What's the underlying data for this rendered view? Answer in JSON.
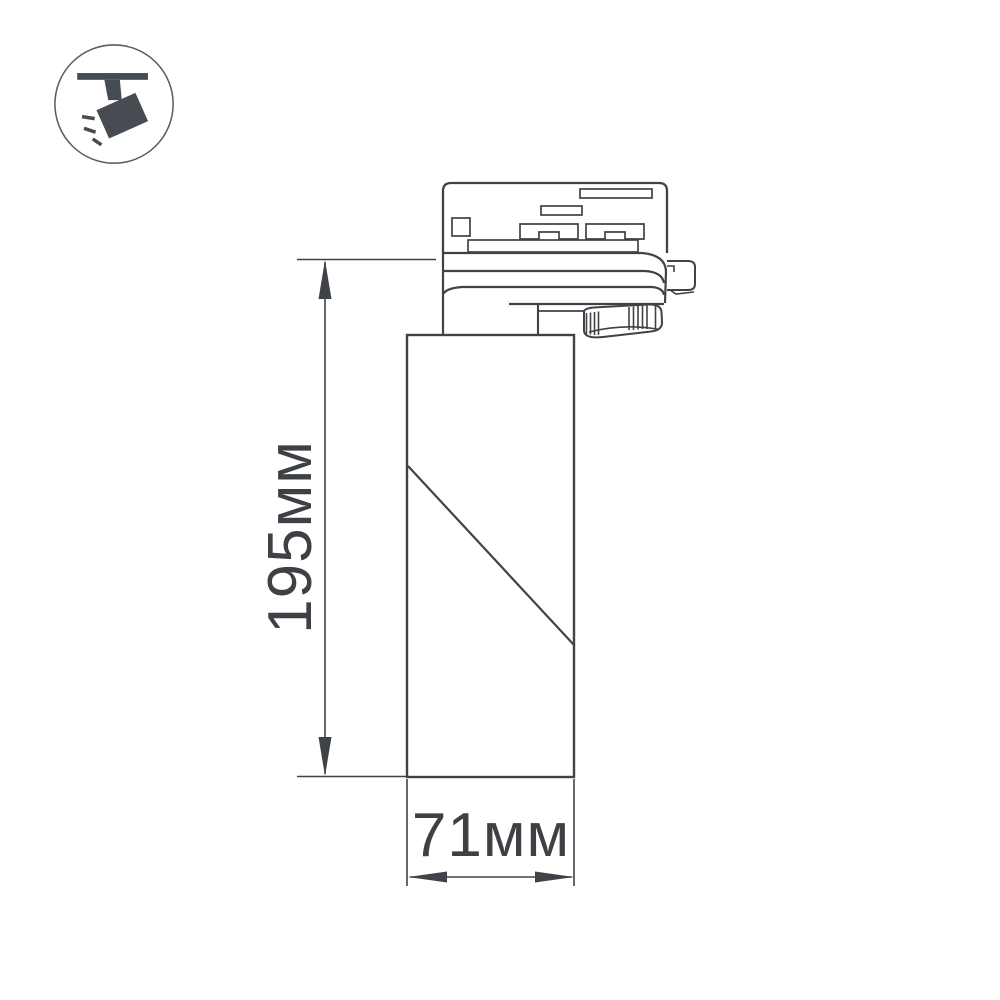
{
  "canvas": {
    "background": "#ffffff",
    "width": 1000,
    "height": 1000
  },
  "palette": {
    "line": "#3f4347",
    "text": "#3d4145",
    "icon_fill": "#474c52",
    "badge_ring": "#595e62"
  },
  "badge": {
    "icon": "track-spotlight-icon",
    "description": "ceiling-track mounted spotlight pictogram with light rays"
  },
  "drawing": {
    "object": "cylindrical track spotlight, side elevation line drawing",
    "dimensions": {
      "height": {
        "label": "195мм",
        "value": 195,
        "unit": "мм",
        "orientation": "vertical"
      },
      "width": {
        "label": "71мм",
        "value": 71,
        "unit": "мм",
        "orientation": "horizontal"
      }
    }
  }
}
